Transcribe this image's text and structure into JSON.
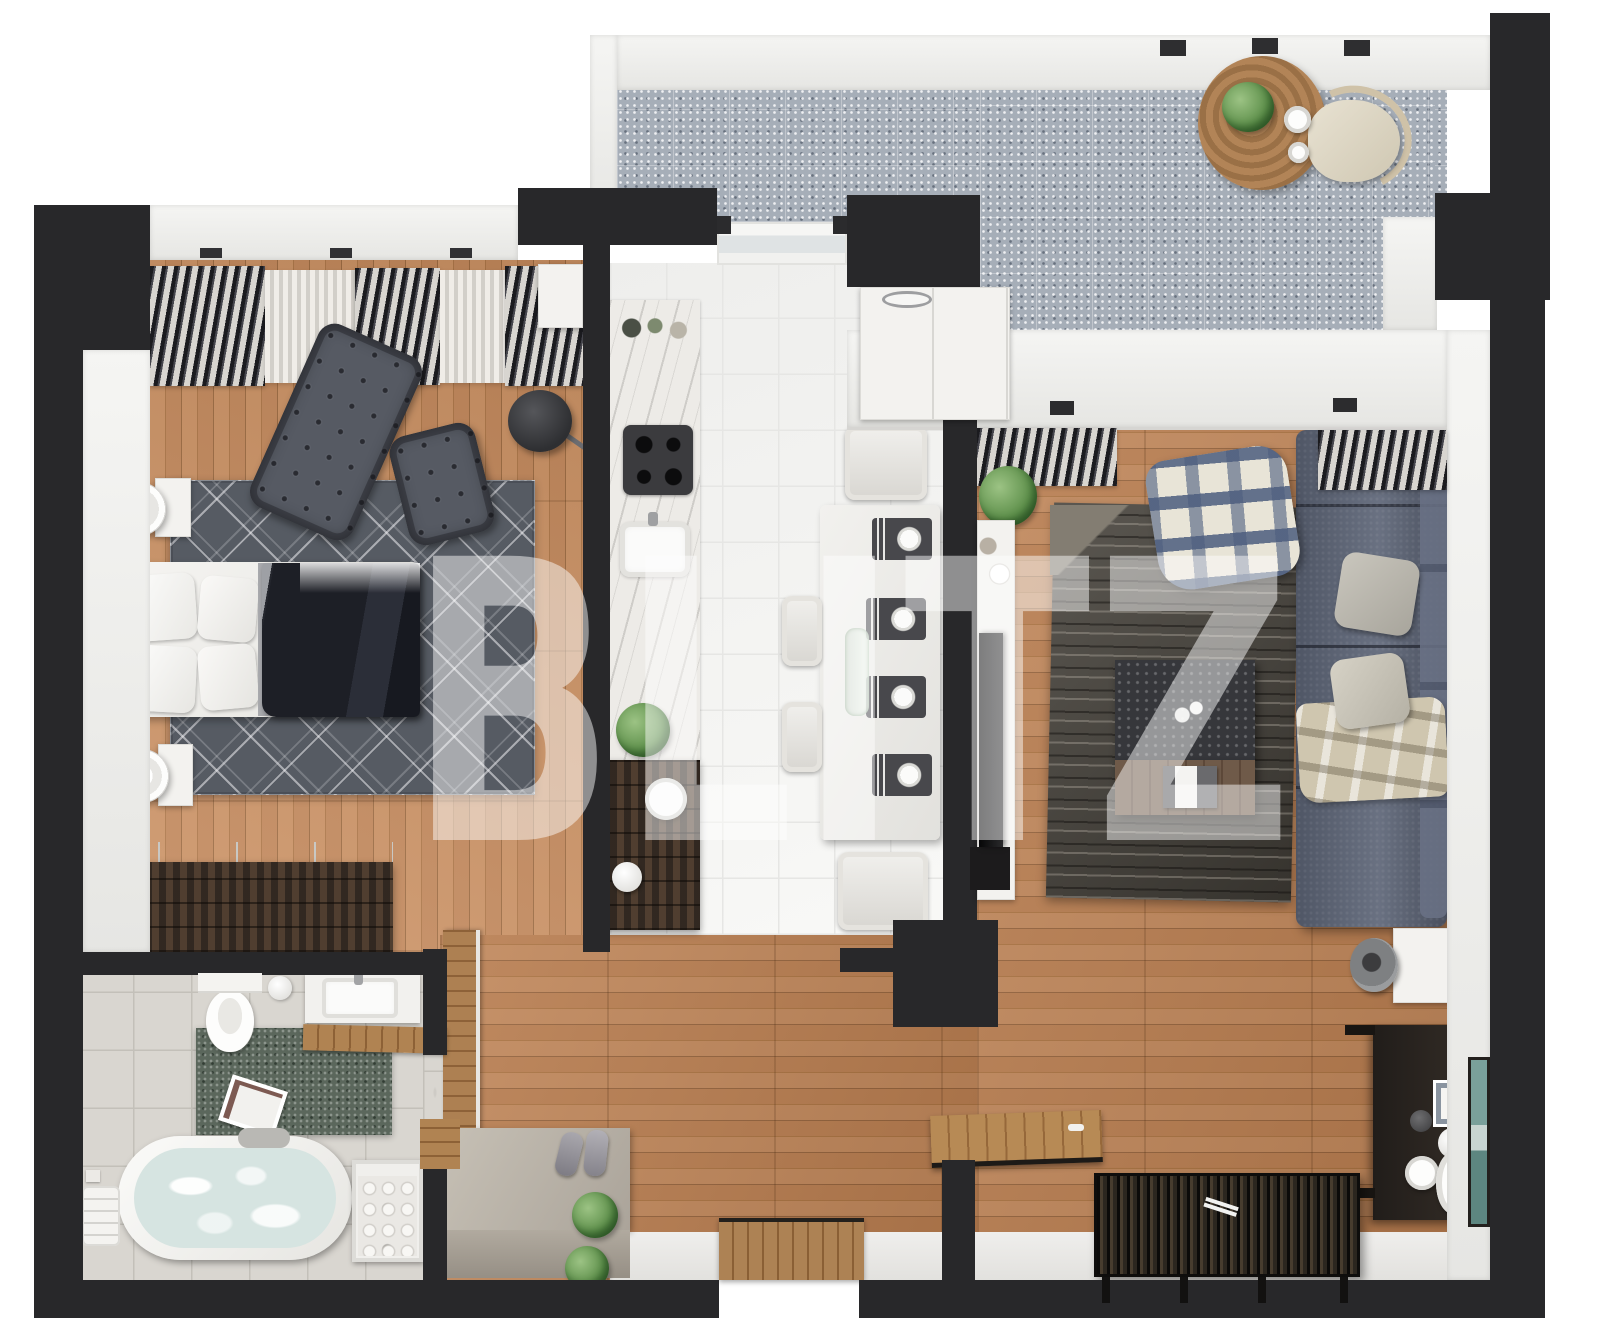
{
  "watermark": {
    "text": "BLITZ"
  },
  "palette": {
    "wall_dark": "#28282a",
    "watermark": "#ffffff",
    "wood_floor": "#b87e51",
    "bedroom_floor": "#c48c5e",
    "terrace_tile": "#a6aeb8",
    "kitchen_tile": "#f8f8f6",
    "bath_tile": "#d9d6d0",
    "sofa_blue": "#5d6577",
    "rug_bedroom": "#565b63",
    "rug_living": "#48443d",
    "rug_bath": "#5b675c",
    "plant_green": "#5d8f4a",
    "water_blue": "#d6e4e1"
  }
}
